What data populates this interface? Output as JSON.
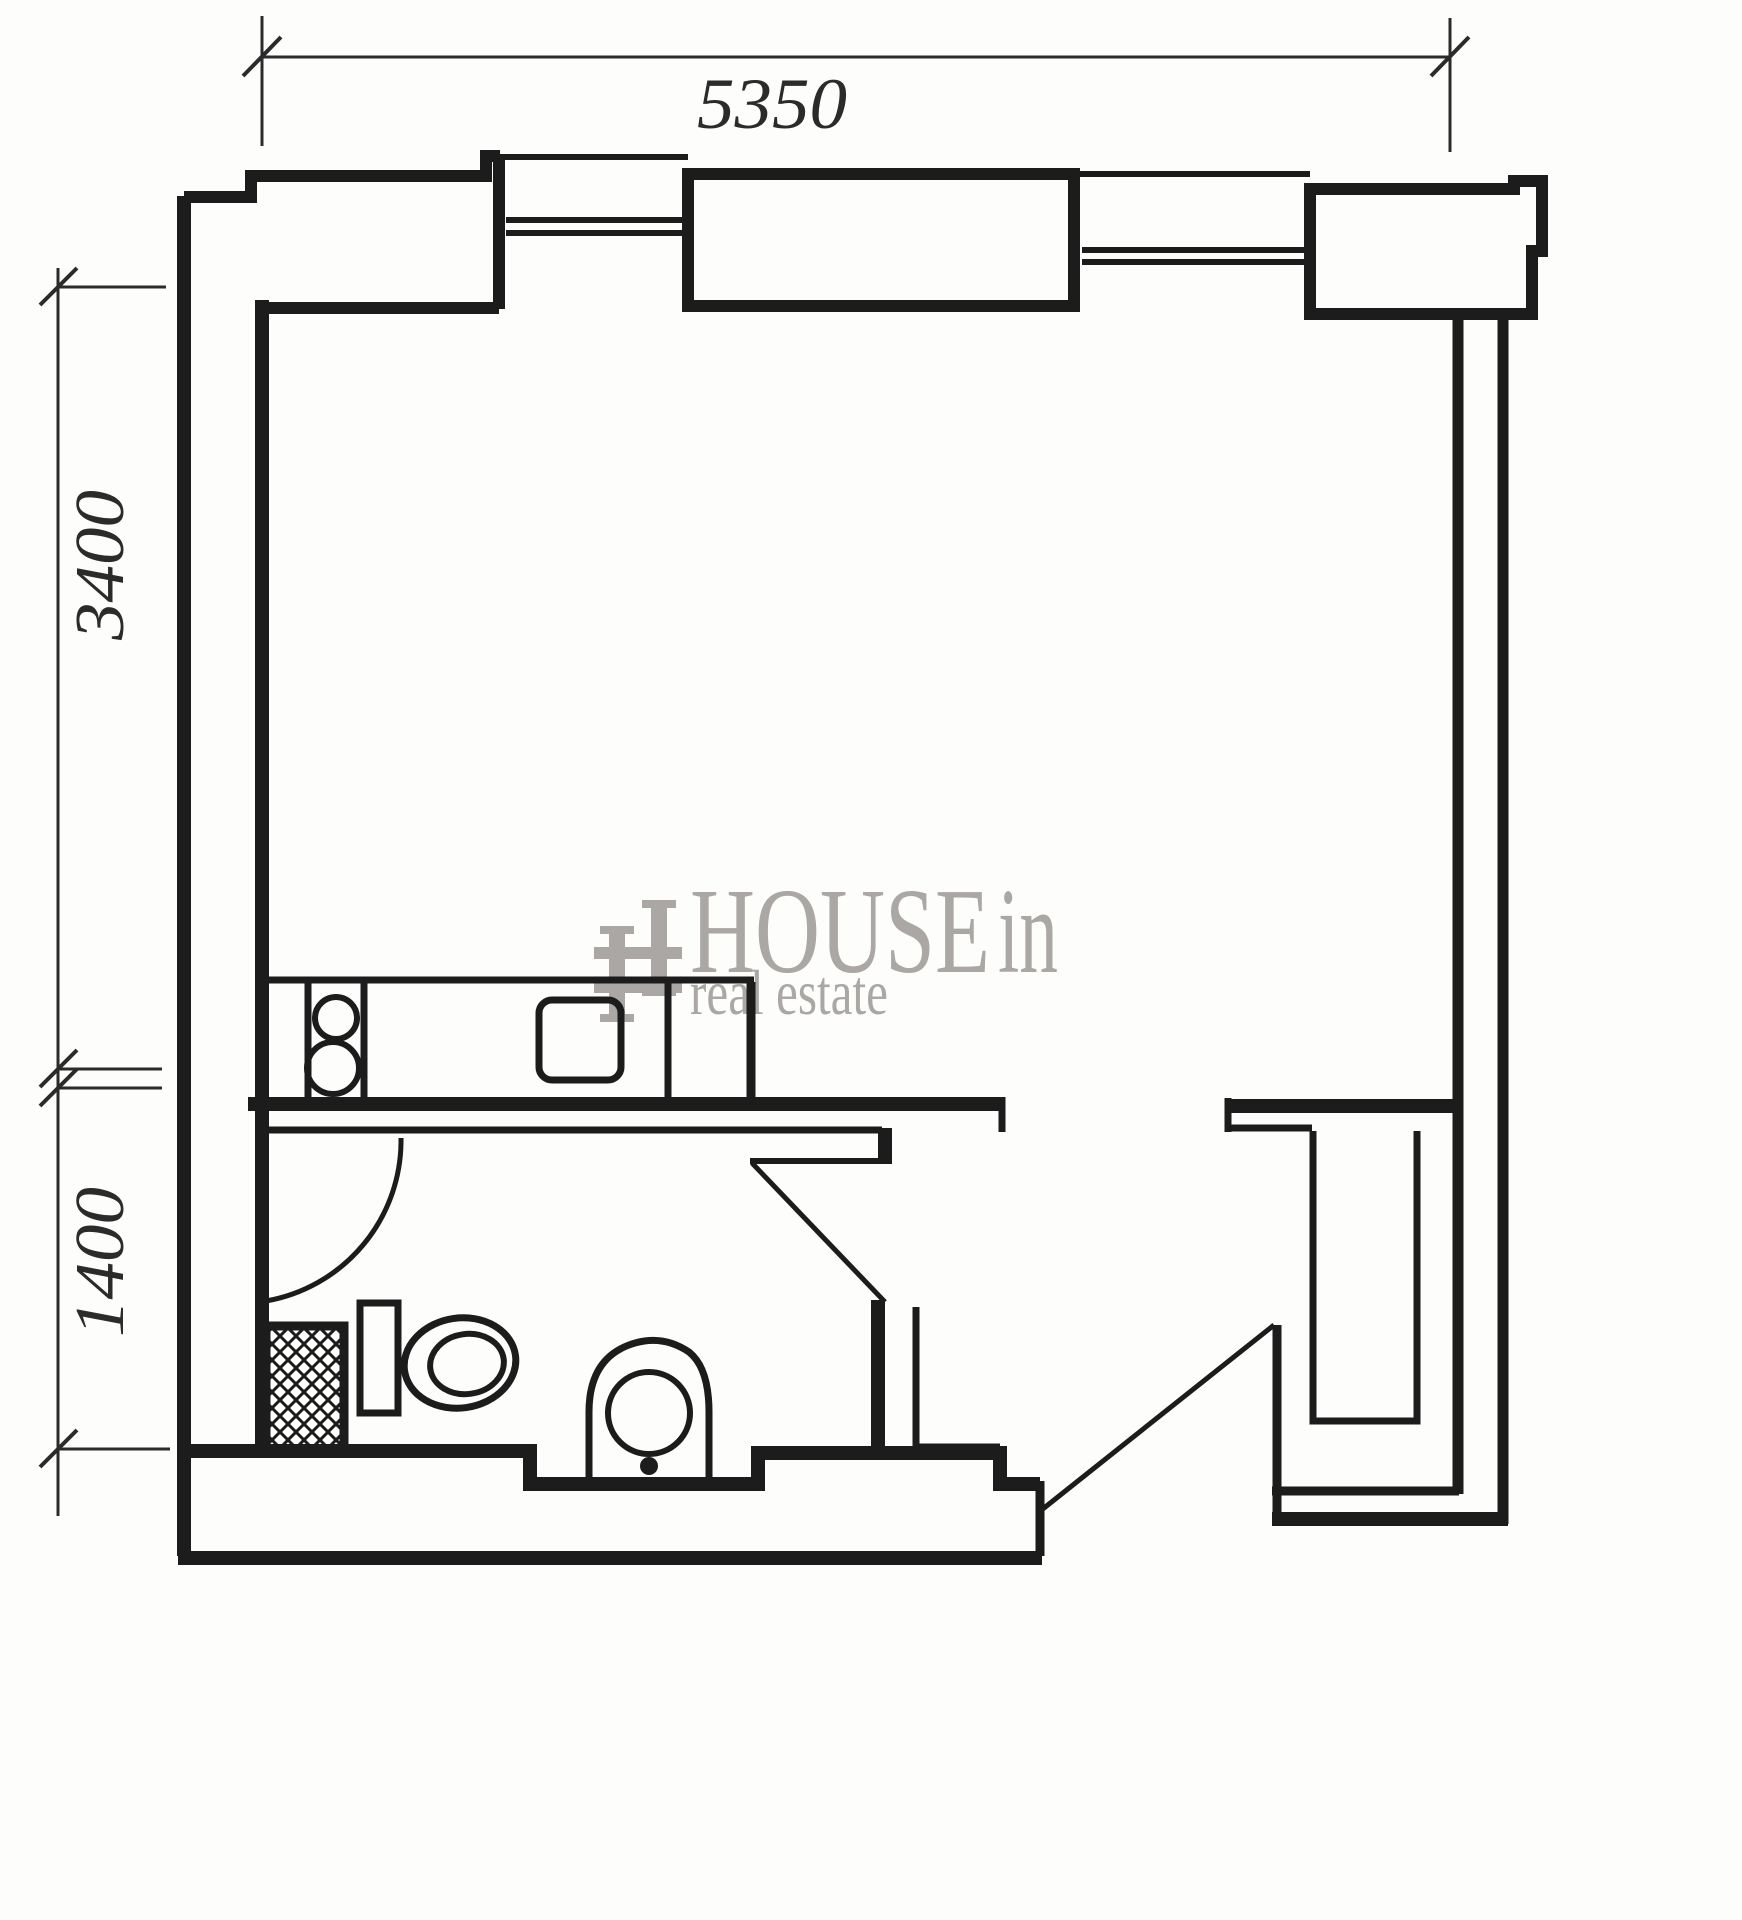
{
  "page": {
    "background": "#fdfdfc",
    "ink_color": "#1c1c1c",
    "type": "apartment floor plan drawing"
  },
  "dimension_labels": {
    "top_width": "5350",
    "left_upper": "3400",
    "left_lower": "1400"
  },
  "watermark": {
    "brand": "HOUSE",
    "brand_suffix": "in",
    "tagline": "real estate",
    "color": "#a6a3a0"
  },
  "plan_symbols": [
    "top-dimension-line",
    "left-dimension-line",
    "exterior-walls",
    "wall-piers",
    "window",
    "window",
    "room-divider-wall",
    "kitchen-counter",
    "stove-burners",
    "kitchen-sink",
    "bathroom-door-arc",
    "bathroom-door",
    "shower-tray",
    "shelf",
    "toilet",
    "washbasin",
    "hall-closet",
    "entry-door"
  ]
}
